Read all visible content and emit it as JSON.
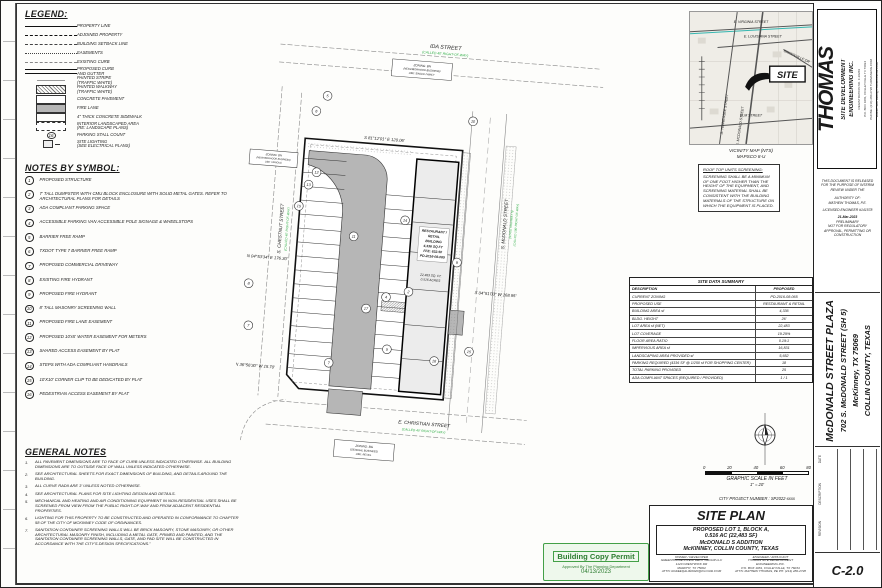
{
  "accent": {
    "green": "#2fae46",
    "stamp_green": "#43a047",
    "pavement_gray": "#b6b6b6"
  },
  "sheet_no": "C-2.0",
  "legend": {
    "title": "LEGEND:",
    "items": [
      {
        "symbol": "s-prop",
        "label": "PROPERTY LINE"
      },
      {
        "symbol": "s-adj",
        "label": "ADJOINED PROPERTY"
      },
      {
        "symbol": "s-setback",
        "label": "BUILDING SETBACK LINE"
      },
      {
        "symbol": "s-ease",
        "label": "EASEMENTS"
      },
      {
        "symbol": "s-excurb",
        "label": "EXISTING CURB"
      },
      {
        "symbol": "s-curb",
        "label": "PROPOSED CURB\nAND GUTTER"
      },
      {
        "symbol": "s-stripe",
        "label": "PAINTED STRIPE\n(TRAFFIC WHITE)"
      },
      {
        "symbol": "s-walk",
        "label": "PAINTED WALKWAY\n(TRAFFIC WHITE)"
      },
      {
        "symbol": "s-conc",
        "label": "CONCRETE PAVEMENT"
      },
      {
        "symbol": "s-fire",
        "label": "FIRE LANE"
      },
      {
        "symbol": "s-side",
        "label": "4\" THICK CONCRETE SIDEWALK"
      },
      {
        "symbol": "s-land",
        "label": "INTERIOR LANDSCAPED AREA\n(RE: LANDSCAPE PLANS)"
      },
      {
        "symbol": "s-count",
        "badge": "16",
        "label": "PARKING STALL COUNT"
      },
      {
        "symbol": "s-light",
        "label": "SITE LIGHTING\n(SEE ELECTRICAL PLANS)"
      }
    ]
  },
  "notes_by_symbol": {
    "title": "NOTES BY SYMBOL:",
    "items": [
      {
        "n": "1",
        "text": "PROPOSED STRUCTURE"
      },
      {
        "n": "2",
        "text": "7' TALL DUMPSTER WITH CMU BLOCK ENCLOSURE WITH SOLID METAL GATES. REFER TO ARCHITECTURAL PLANS FOR DETAILS"
      },
      {
        "n": "3",
        "text": "ADA COMPLIANT PARKING SPACE"
      },
      {
        "n": "4",
        "text": "ACCESSIBLE PARKING VAN ACCESSIBLE POLE SIGNAGE & WHEELSTOPS"
      },
      {
        "n": "5",
        "text": "BARRIER FREE RAMP"
      },
      {
        "n": "6",
        "text": "TXDOT TYPE 7 BARRIER FREE RAMP"
      },
      {
        "n": "7",
        "text": "PROPOSED COMMERCIAL DRIVEWAY"
      },
      {
        "n": "8",
        "text": "EXISTING FIRE HYDRANT"
      },
      {
        "n": "9",
        "text": "PROPOSED FIRE HYDRANT"
      },
      {
        "n": "10",
        "text": "8' TALL MASONRY SCREENING WALL"
      },
      {
        "n": "11",
        "text": "PROPOSED FIRE LANE EASEMENT"
      },
      {
        "n": "12",
        "text": "PROPOSED 10'x5' WATER EASEMENT FOR METERS"
      },
      {
        "n": "13",
        "text": "SHARED ACCESS EASEMENT BY PLAT"
      },
      {
        "n": "14",
        "text": "STEPS WITH ADA COMPLIANT HANDRAILS"
      },
      {
        "n": "15",
        "text": "10'X10' CORNER CLIP TO BE DEDICATED BY PLAT"
      },
      {
        "n": "16",
        "text": "PEDESTRIAN ACCESS EASEMENT BY PLAT"
      }
    ]
  },
  "general_notes": {
    "title": "GENERAL NOTES",
    "items": [
      {
        "n": "1.",
        "text": "ALL PAVEMENT DIMENSIONS ARE TO FACE OF CURB UNLESS INDICATED OTHERWISE. ALL BUILDING DIMENSIONS ARE TO OUTSIDE FACE OF WALL UNLESS INDICATED OTHERWISE."
      },
      {
        "n": "2.",
        "text": "SEE ARCHITECTURAL SHEETS FOR EXACT DIMENSIONS OF BUILDING, AND DETAILS AROUND THE BUILDING."
      },
      {
        "n": "3.",
        "text": "ALL CURVE RADII ARE 3' UNLESS NOTED OTHERWISE."
      },
      {
        "n": "4.",
        "text": "SEE ARCHITECTURAL PLANS FOR SITE LIGHTING DESIGN AND DETAILS."
      },
      {
        "n": "5.",
        "text": "MECHANICAL AND HEATING AND AIR CONDITIONING EQUIPMENT IN NON-RESIDENTIAL USES SHALL BE SCREENED FROM VIEW FROM THE PUBLIC RIGHT-OF-WAY AND FROM ADJACENT RESIDENTIAL PROPERTIES."
      },
      {
        "n": "6.",
        "text": "LIGHTING FOR THIS PROPERTY TO BE CONSTRUCTED AND OPERATED IN CONFORMANCE TO CHAPTER 58 OF THE CITY OF MCKINNEY CODE OF ORDINANCES."
      },
      {
        "n": "7.",
        "text": "SANITATION CONTAINER SCREENING WALLS WILL BE BRICK MASONRY, STONE MASONRY, OR OTHER ARCHITECTURAL MASONRY FINISH, INCLUDING A METAL GATE, PRIMED AND PAINTED, AND THE SANITATION CONTAINER SCREENING WALLS, GATE, AND PAD SITE WILL BE CONSTRUCTED IN ACCORDANCE WITH THE CITY'S DESIGN SPECIFICATIONS.\""
      }
    ]
  },
  "plan": {
    "streets": {
      "ida": {
        "name": "IDA STREET",
        "row": "(CALLED 40' RIGHT-OF-WAY)"
      },
      "chestnut": {
        "name": "S. CHESTNUT STREET",
        "row": "(CALLED 40' RIGHT-OF-WAY)"
      },
      "mcdonald": {
        "name": "S. McDONALD STREET",
        "row": "(STATE HIGHWAY 5)",
        "row2": "(CALLED 100' RIGHT-OF-WAY)"
      },
      "christian": {
        "name": "E. CHRISTIAN STREET",
        "row": "(CALLED 40' RIGHT-OF-WAY)"
      }
    },
    "bearings": {
      "top": "S 81°12'01\" E   120.06'",
      "left": "N 04°53'34\" E   176.30'",
      "right": "S 04°51'03\" W   168.95'",
      "bottom": "N 36°56'30\" W   15.70'"
    },
    "zoning_north": {
      "l1": "ZONING: BN",
      "l2": "(NEIGHBORHOOD BUSINESS)",
      "l3": "USE: SINGLE FAMILY"
    },
    "zoning_west": {
      "l1": "ZONING: BN",
      "l2": "(NEIGHBORHOOD BUSINESS)",
      "l3": "USE: VARIOUS"
    },
    "zoning_south": {
      "l1": "ZONING: BG",
      "l2": "(GENERAL BUSINESS)",
      "l3": "USE: RETAIL"
    },
    "building": {
      "l1": "RESTAURANT /",
      "l2": "RETAIL",
      "l3": "BUILDING",
      "l4": "4,336 SQ FT",
      "l5": "FFE: 632.50",
      "l6": "PD-2016-08-065"
    },
    "lot": {
      "l1": "22,483 SQ. FT.",
      "l2": "0.516 ACRES"
    },
    "callouts": [
      "5",
      "6",
      "10",
      "12",
      "13",
      "15",
      "8",
      "7",
      "11",
      "14",
      "2",
      "4",
      "17",
      "7",
      "5",
      "16",
      "15",
      "9"
    ]
  },
  "roof_note": {
    "title": "ROOF TOP UNITS SCREENING:",
    "body": "SCREENING SHALL BE A MINIMUM OF ONE FOOT HIGHER THAN THE HEIGHT OF THE EQUIPMENT, AND SCREENING MATERIAL SHALL BE CONSISTENT WITH THE BUILDING MATERIALS OF THE STRUCTURE ON WHICH THE EQUIPMENT IS PLACED."
  },
  "vicinity": {
    "streets": [
      "E. VIRGINIA STREET",
      "E. LOUISIANA STREET",
      "GREENVILLE DR",
      "S. TENNESSEE STREET",
      "S. MCDONALD STREET",
      "ELM STREET"
    ],
    "site": "SITE",
    "caption1": "VICINITY MAP (NTS)",
    "caption2": "MAPSCO 8-U"
  },
  "site_data": {
    "title": "SITE DATA SUMMARY",
    "headers": [
      "DESCRIPTION",
      "PROPOSED"
    ],
    "rows": [
      [
        "CURRENT ZONING",
        "PD-2016-08-065"
      ],
      [
        "PROPOSED USE",
        "RESTAURANT & RETAIL"
      ],
      [
        "BUILDING AREA sf",
        "4,336"
      ],
      [
        "BLDG. HEIGHT",
        "26'"
      ],
      [
        "LOT AREA sf (NET)",
        "22,483"
      ],
      [
        "LOT COVERAGE",
        "19.29%"
      ],
      [
        "FLOOR AREA RATIO",
        "0.19:1"
      ],
      [
        "IMPERVIOUS AREA sf",
        "16,831"
      ],
      [
        "LANDSCAPING AREA PROVIDED sf",
        "5,652"
      ],
      [
        "PARKING REQUIRED (4336 SF @ 1/250 sf FOR SHOPPING CENTER)",
        "18"
      ],
      [
        "TOTAL PARKING PROVIDED",
        "25"
      ],
      [
        "ADA COMPLIANT SPACES (REQUIRED / PROVIDED)",
        "1 / 1"
      ]
    ]
  },
  "graphic_scale": {
    "ticks": [
      "0",
      "20",
      "40",
      "60",
      "80"
    ],
    "caption": "GRAPHIC SCALE IN FEET",
    "ratio": "1\" = 20'"
  },
  "city_project": "CITY PROJECT NUMBER : SP2022-xxxx",
  "titleblock": {
    "title": "SITE PLAN",
    "subtitle": {
      "l1": "PROPOSED LOT 1, BLOCK A,",
      "l2": "0.516 AC (22,483 SF)",
      "l3": "McDONALD S ADDITION",
      "l4": "McKINNEY,  COLLIN COUNTY, TEXAS"
    },
    "owner": {
      "hd": "OWNER / DEVELOPER",
      "l1": "GREENHOUSE INVESTMENT GROUP LLC",
      "l2": "1120 CRESTWICK DR",
      "l3": "MURPHY, TX 75094",
      "l4": "ATTN: RAFEEQALIM2020@ICLOUD.COM"
    },
    "engineer": {
      "hd": "ENGINEER / APPLICANT",
      "l1": "THOMAS SITE DEVELOPMENT",
      "l2": "ENGINEERING INC.",
      "l3": "P.O. BOX 1081, COLLEYVILLE, TX 76034",
      "l4": "ATTN: MATHEW THOMAS, PE   PH: (214) 280-2728"
    }
  },
  "stamp": {
    "line1": "Building Copy Permit",
    "line2": "Approved By The Planning Department",
    "date": "04/13/2023"
  },
  "firm": {
    "name": "THOMAS",
    "tag1": "SITE DEVELOPMENT",
    "tag2": "ENGINEERING INC.",
    "reg": "REGISTRATION NO. F-10269",
    "addr": "P.O. BOX 1081, COLLEYVILLE TX 76034",
    "phone": "PHONE: (214) 280-2728  THOMASENG.COM",
    "email": "EMAIL: MATHEW@THOMAS-ENG.COM"
  },
  "release": {
    "lines": [
      "THIS DOCUMENT IS RELEASED",
      "FOR THE PURPOSE OF INTERIM",
      "REVIEW UNDER THE",
      "AUTHORITY OF:",
      "MATHEW THOMAS, P.E.",
      "LICENSED ENGINEER #141578",
      "21-Mar-2023",
      "PRELIMINARY",
      "NOT FOR REGULATORY",
      "APPROVAL, PERMITTING OR",
      "CONSTRUCTION"
    ]
  },
  "project": {
    "l1": "McDONALD STREET PLAZA",
    "l2": "702 S. McDONALD STREET (SH 5)",
    "l3": "McKinney, TX 75069",
    "l4": "COLLIN COUNTY, TEXAS"
  },
  "revision": {
    "labels": [
      "DATE",
      "DESCRIPTION",
      "REVISION"
    ]
  }
}
